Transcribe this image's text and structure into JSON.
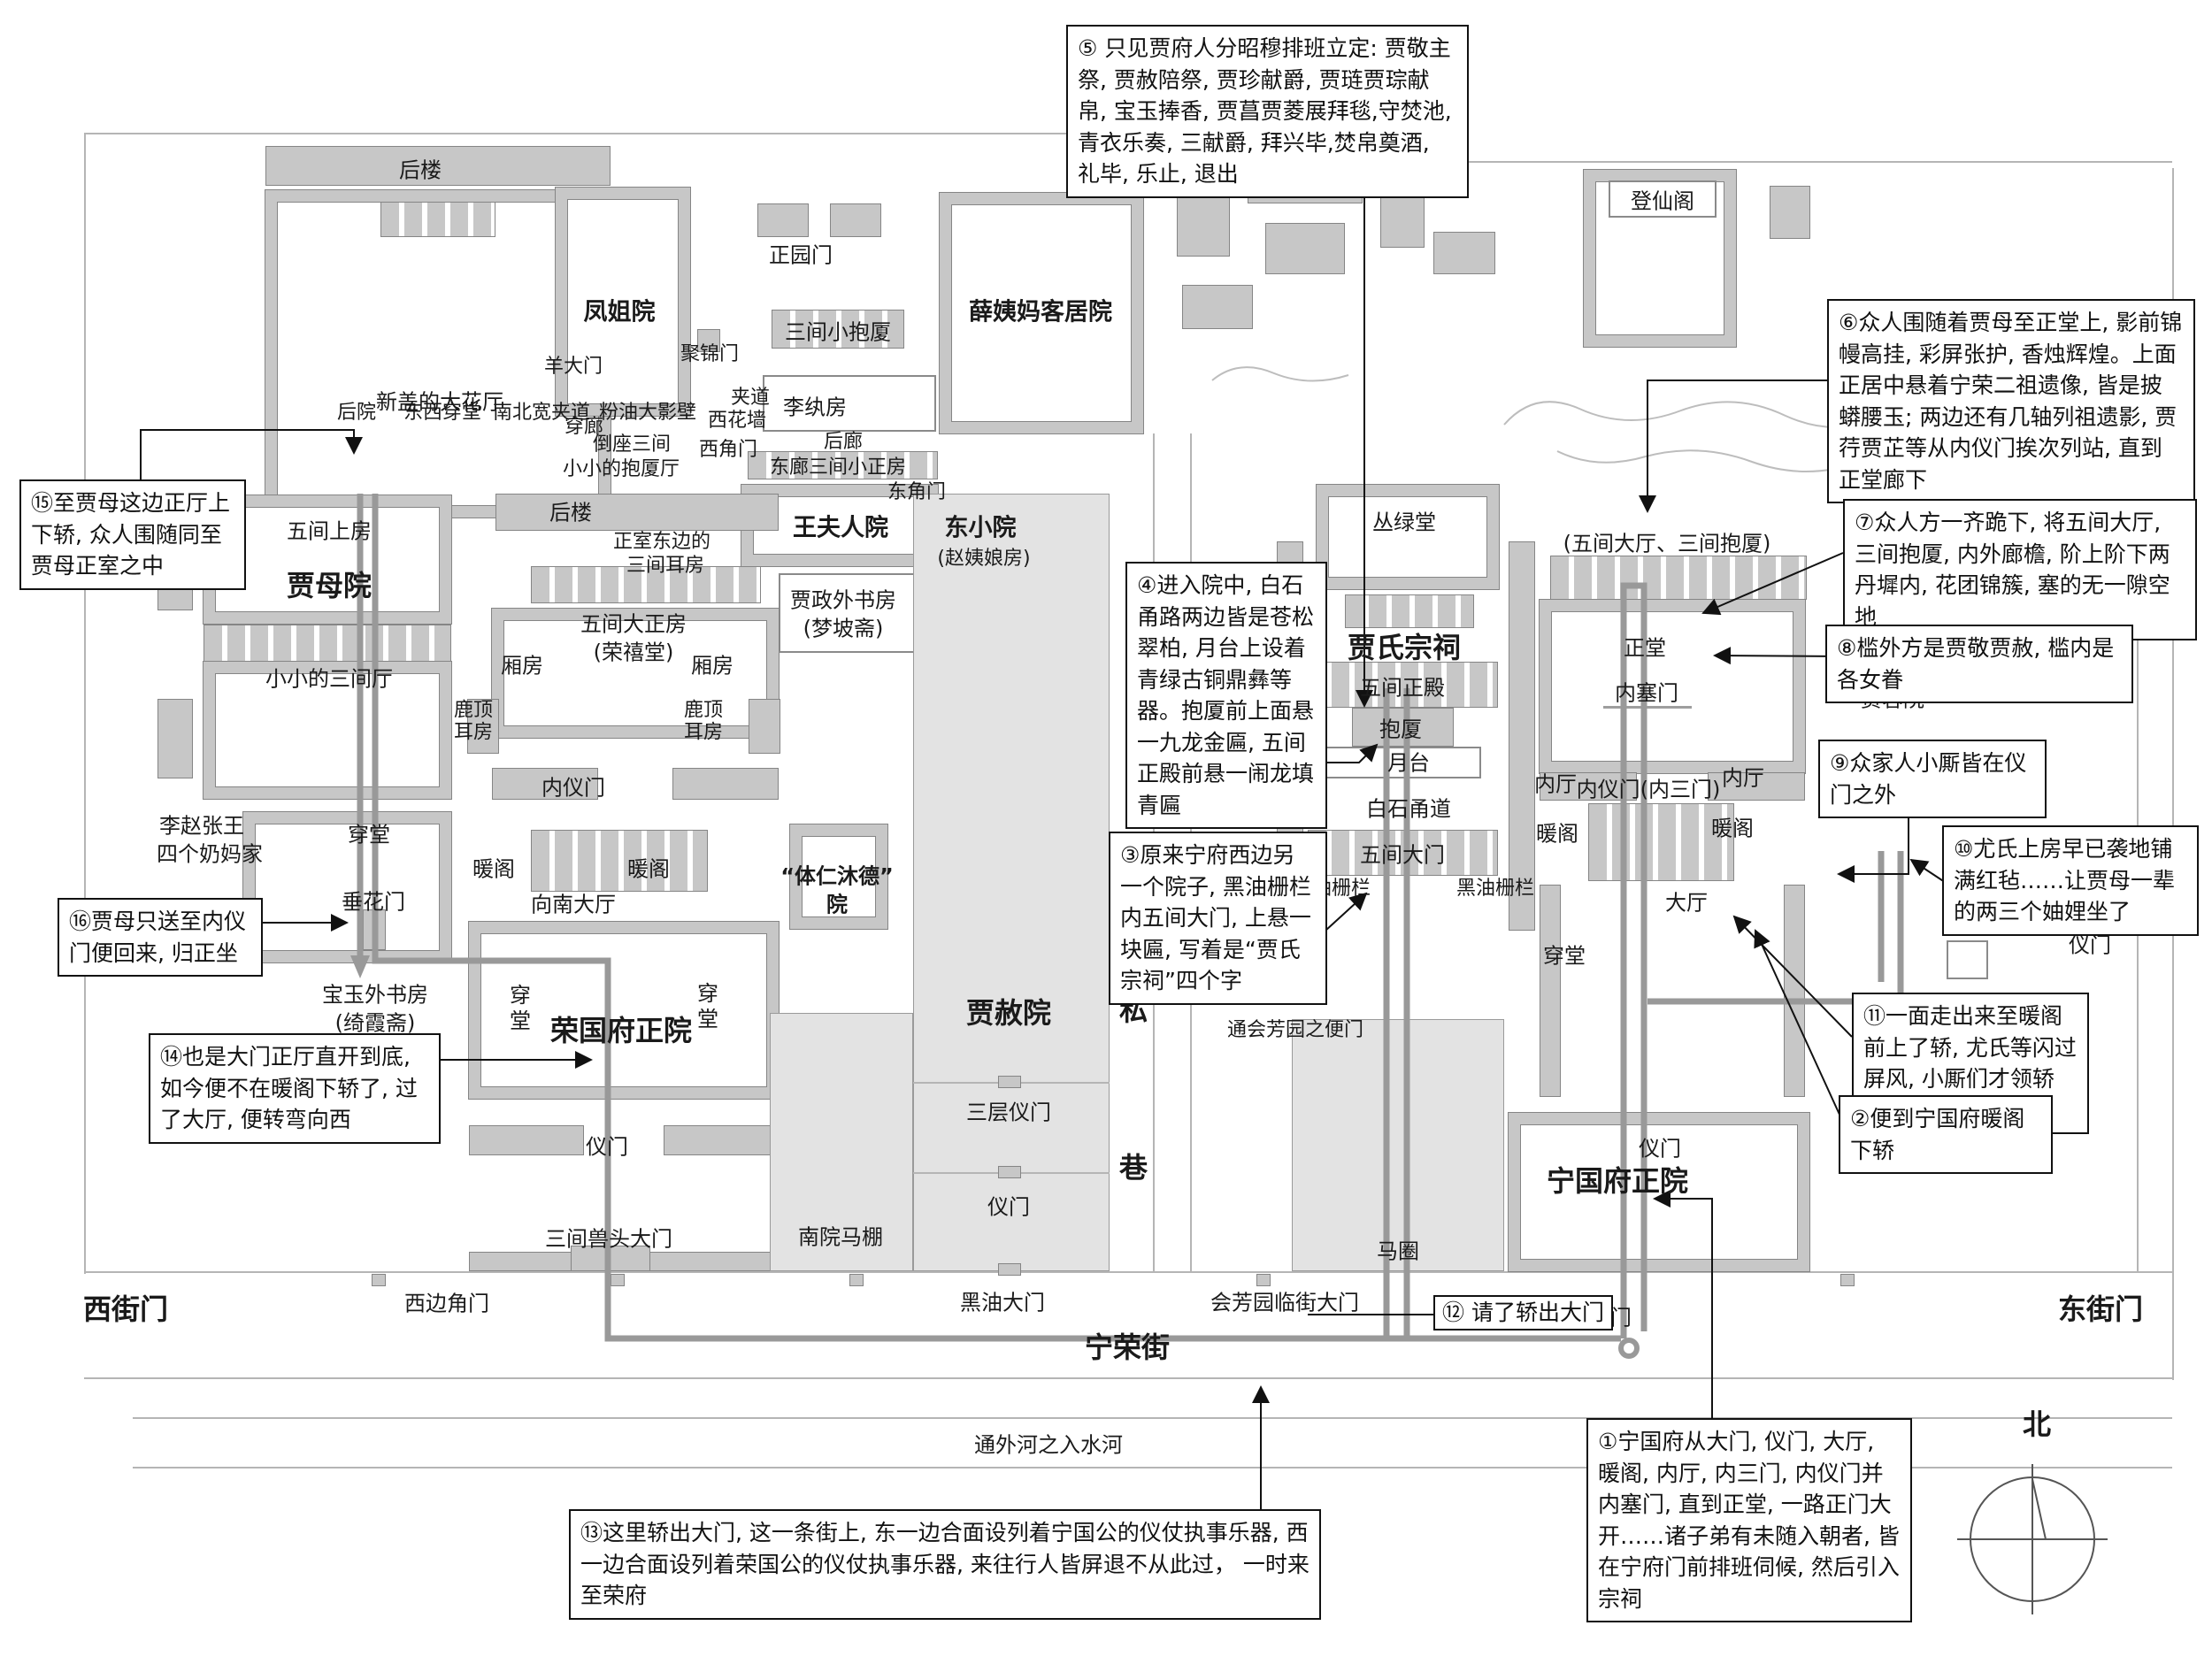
{
  "title": "宁荣二府平面示意图（贾母祭宗祠路线）",
  "colors": {
    "wall": "#c7c7c7",
    "light_block": "#e3e3e3",
    "route": "#999999",
    "outline": "#858585",
    "ink": "#111111"
  },
  "notes": {
    "n1": "①宁国府从大门, 仪门, 大厅, 暖阁, 内厅, 内三门, 内仪门并内塞门, 直到正堂, 一路正门大开……诸子弟有未随入朝者, 皆在宁府门前排班伺候, 然后引入宗祠",
    "n2": "②便到宁国府暖阁下轿",
    "n3": "③原来宁府西边另一个院子, 黑油栅栏内五间大门, 上悬一块匾, 写着是“贾氏宗祠”四个字",
    "n4": "④进入院中, 白石甬路两边皆是苍松翠柏, 月台上设着青绿古铜鼎彝等器。抱厦前上面悬一九龙金匾, 五间正殿前悬一闹龙填青匾",
    "n5": "⑤ 只见贾府人分昭穆排班立定: 贾敬主祭, 贾赦陪祭, 贾珍献爵, 贾琏贾琮献帛, 宝玉捧香, 贾菖贾菱展拜毯,守焚池, 青衣乐奏, 三献爵, 拜兴毕,焚帛奠酒, 礼毕, 乐止, 退出",
    "n6": "⑥众人围随着贾母至正堂上, 影前锦幔高挂, 彩屏张护, 香烛辉煌。上面正居中悬着宁荣二祖遗像, 皆是披蟒腰玉; 两边还有几轴列祖遗影, 贾荇贾芷等从内仪门挨次列站, 直到正堂廊下",
    "n7": "⑦众人方一齐跪下, 将五间大厅, 三间抱厦, 内外廊檐, 阶上阶下两丹墀内, 花团锦簇, 塞的无一隙空地",
    "n8": "⑧槛外方是贾敬贾赦, 槛内是各女眷",
    "n9": "⑨众家人小厮皆在仪门之外",
    "n10": "⑩尤氏上房早已袭地铺满红毡……让贾母一辈的两三个妯娌坐了",
    "n11": "⑪一面走出来至暖阁前上了轿, 尤氏等闪过屏风, 小厮们才领轿夫,",
    "n12": "⑫ 请了轿出大门",
    "n13": "⑬这里轿出大门, 这一条街上, 东一边合面设列着宁国公的仪仗执事乐器, 西一边合面设列着荣国公的仪仗执事乐器, 来往行人皆屏退不从此过， 一时来至荣府",
    "n14": "⑭也是大门正厅直开到底, 如今便不在暖阁下轿了, 过了大厅, 便转弯向西",
    "n15": "⑮至贾母这边正厅上下轿, 众人围随同至贾母正室之中",
    "n16": "⑯贾母只送至内仪门便回来, 归正坐"
  },
  "labels": {
    "houlou": "后楼",
    "dahuating": "新盖的大花厅",
    "chuanlang": "穿廊",
    "fengjieyuan": "凤姐院",
    "yangdamen": "羊大门",
    "jujinmen": "聚锦门",
    "houyuan": "后院",
    "dongxichuantang": "东西穿堂",
    "nanbeijiadao": "南北宽夹道",
    "fenyouyingbi": "粉油大影壁",
    "daozuosanjian": "倒座三间",
    "xiaobaoshating": "小小的抱厦厅",
    "zhengyuanmen": "正园门",
    "sanjianxiaobaosha": "三间小抱厦",
    "xueyima": "薛姨妈客居院",
    "jiadao": "夹道",
    "xihuaqiang": "西花墙",
    "xijiaomen": "西角门",
    "liwanfang": "李纨房",
    "houlang": "后廊",
    "donglangsanjian": "东廊三间小正房",
    "dongjiaomen": "东角门",
    "wangfurenyuan": "王夫人院",
    "dongxiaoyuan": "东小院",
    "zhaoyiniang": "(赵姨娘房)",
    "jiazhengshufang": "贾政外书房",
    "mengpozhai": "(梦坡斋)",
    "zhengshidongbian": "正室东边的",
    "sanjianerfang": "三间耳房",
    "wujiandazhengfang": "五间大正房",
    "rongxitang": "(荣禧堂)",
    "xiangfang": "厢房",
    "ludingerfang": "鹿顶耳房",
    "neiyimen": "内仪门",
    "nuange": "暖阁",
    "xiangnandating": "向南大厅",
    "wujianshangfang": "五间上房",
    "jiamuyuan": "贾母院",
    "xiaosanjianting": "小小的三间厅",
    "chuantang": "穿堂",
    "chuihuamen": "垂花门",
    "lizhaozhangwang": "李赵张王",
    "sigenaimajia": "四个奶妈家",
    "baoyushufang": "宝玉外书房",
    "qixiazhai": "(绮霞斋)",
    "rongguozhengyuan": "荣国府正院",
    "yimen": "仪门",
    "shoutoudamen": "三间兽头大门",
    "nanyuanmapeng": "南院马棚",
    "tirenmude": "“体仁沐德”",
    "yuan": "院",
    "jiasheyuan": "贾赦院",
    "sancengyimen": "三层仪门",
    "heiyoudamen": "黑油大门",
    "si": "私",
    "xiang": "巷",
    "dengxiange": "登仙阁",
    "conglvtang": "丛绿堂",
    "jiashizongci": "贾氏宗祠",
    "wujianzhengdian": "五间正殿",
    "baosha": "抱厦",
    "yuetai": "月台",
    "baishiyongdao": "白石甬道",
    "wujiandamen": "五间大门",
    "heiyoushanlan": "黑油栅栏",
    "huifangbianmen": "通会芳园之便门",
    "maquan": "马圈",
    "wujiandating": "(五间大厅、三间抱厦)",
    "zhengtang": "正堂",
    "neisaimen": "内塞门",
    "neiting": "内厅",
    "neiyimenneisanmen": "内仪门(内三门)",
    "dating": "大厅",
    "jiarongyuan": "贾蓉院",
    "youshiyuan": "尤氏院",
    "ningguozhengyuan": "宁国府正院",
    "damen": "大门",
    "xiaoshufang": "小书房",
    "xijiemen": "西街门",
    "xibianjiaomen": "西边角门",
    "ningrongjie": "宁荣街",
    "huifangyuandamen": "会芳园临街大门",
    "dongjiemen": "东街门",
    "waihe": "通外河之入水河",
    "bei": "北"
  }
}
